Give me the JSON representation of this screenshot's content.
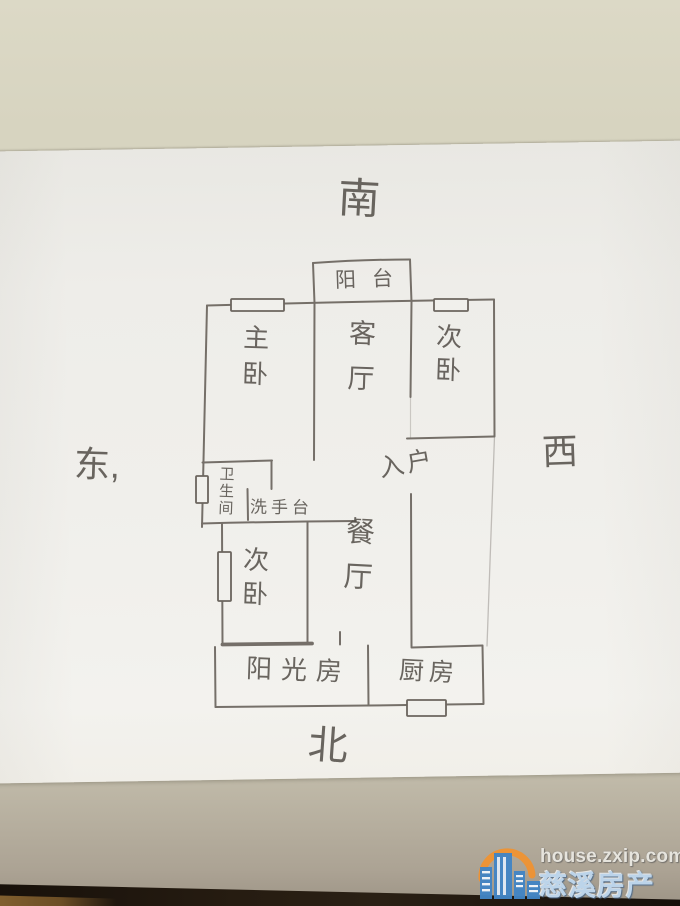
{
  "floorplan": {
    "compass": {
      "south": "南",
      "north": "北",
      "east": "东,",
      "west": "西"
    },
    "rooms": {
      "balcony": "阳台",
      "living": "客厅",
      "master": "主卧",
      "bedroom_ne": "次卧",
      "bedroom_sw": "次卧",
      "entry": "入户",
      "bathroom": "卫生间",
      "washbasin": "洗手台",
      "dining": "餐厅",
      "sunroom": "阳光房",
      "kitchen": "厨房"
    }
  },
  "watermark": {
    "site_url": "house.zxip.com",
    "site_name": "慈溪房产网",
    "logo_colors": {
      "buildings": "#4285c5",
      "sun": "#ef9231"
    }
  },
  "colors": {
    "desk": "#d7d4c0",
    "paper": "#f0efeb",
    "pencil": "#6b655e",
    "table_edge": "#241b12"
  }
}
